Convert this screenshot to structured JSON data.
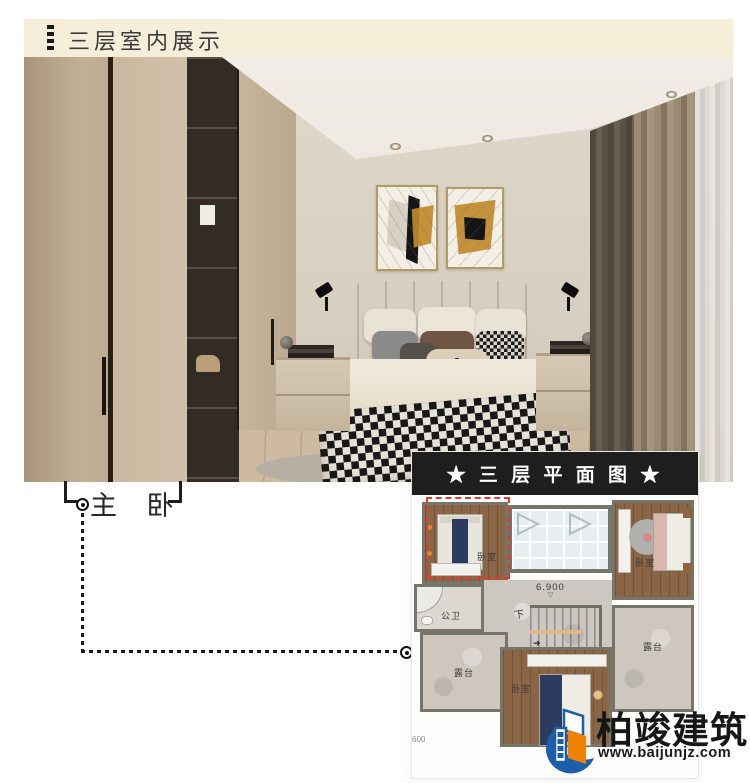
{
  "header": {
    "title": "三层室内展示"
  },
  "photo": {
    "room_label": "主 卧"
  },
  "floorplan": {
    "banner_title": "★ 三 层 平 面 图 ★",
    "labels": {
      "bedroom_top_left": "卧室",
      "bedroom_top_right": "卧室",
      "bedroom_bottom": "卧室",
      "bathroom": "公卫",
      "terrace_left": "露台",
      "terrace_right": "露台",
      "stair_down": "下",
      "stair_arrow": "➔",
      "elevation": "6.900",
      "elevation_mark": "▽",
      "dimension": "600"
    }
  },
  "branding": {
    "company": "柏竣建筑",
    "website": "www.baijunjz.com"
  },
  "colors": {
    "header_bg": "#f7eeda",
    "banner_bg": "#1e1e1e",
    "highlight_red": "#e03a2c",
    "logo_blue": "#1c5fa8",
    "logo_orange": "#ef8200"
  }
}
